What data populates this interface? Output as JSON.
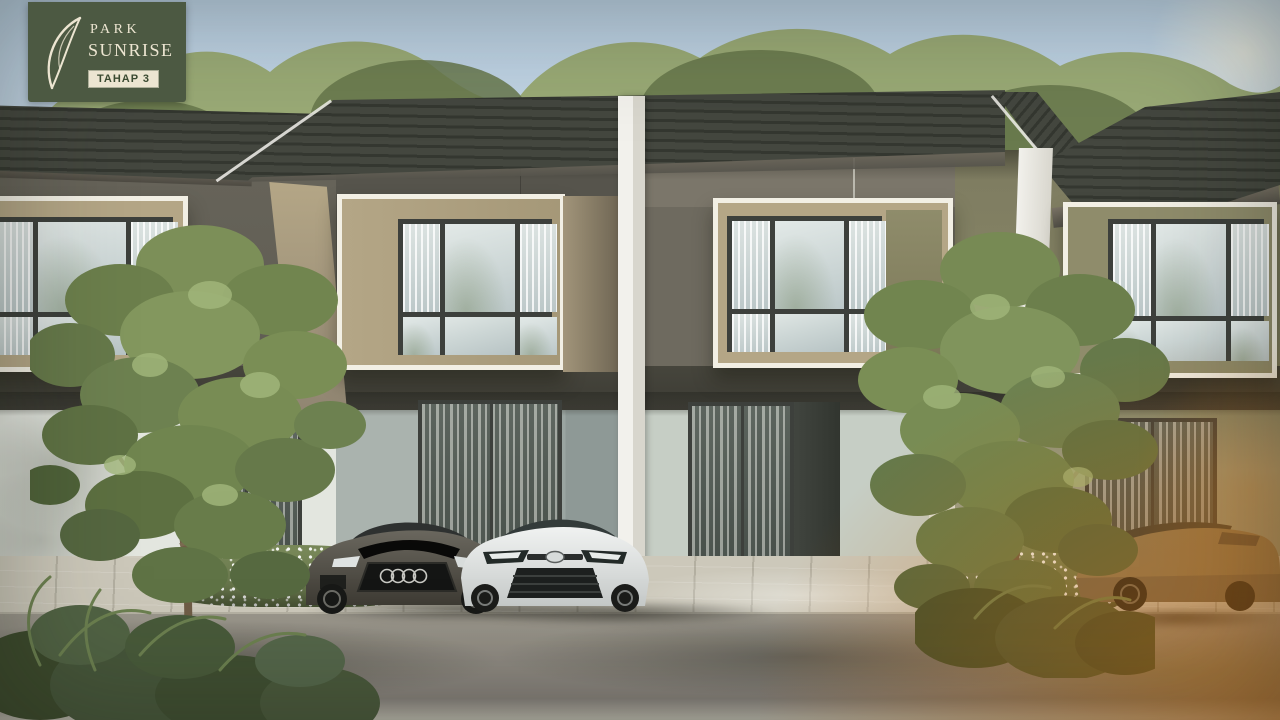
{
  "branding": {
    "line1": "PARK",
    "line2": "SUNRISE",
    "badge": "TAHAP 3",
    "logo_mark": "leaf-swoosh"
  },
  "scene": {
    "type": "architectural-exterior-render",
    "subject": "row of modern two-storey townhouses with parked cars and trees",
    "units_visible": 4,
    "cars": [
      "dark-grey-sedan",
      "white-sedan",
      "bronze-coupe"
    ]
  },
  "palette": {
    "sky_top": "#b9cfe2",
    "sky_bottom": "#dfe8ee",
    "canopy_back": "#9aaa76",
    "canopy_front": "#7a8b58",
    "canopy_dark": "#66774b",
    "roof": "#44473f",
    "roof_rib": "#343730",
    "soffit": "#7b7466",
    "wall_u1": "#5e5b51",
    "wall_u2": "#56544c",
    "wall_u3": "#6e6a5f",
    "wall_u4": "#8c8a69",
    "box_frame": "#f2efe4",
    "tan": "#b4a686",
    "olive_panel": "#8f8c6b",
    "win_frame": "#3d403c",
    "glass_hi": "#dfe6e4",
    "glass_lo": "#b7c3c4",
    "band": "#3c3b34",
    "g_white": "#e3e6df",
    "g_sage": "#c6cec5",
    "g_teal": "#8e9996",
    "g_olive": "#9aa18c",
    "pillar_hi": "#f2f1ec",
    "pillar_lo": "#d8d6cd",
    "pave": "#ccc8ba",
    "pave_edge": "#b5b1a3",
    "asphalt_hi": "#9a968b",
    "asphalt_lo": "#847f79",
    "flower_green": "#5d6b44",
    "trunk": "#6f5d46",
    "leaf_mid": "#7d9059",
    "leaf_dark": "#5f7245",
    "leaf_hi": "#a3b87c",
    "bush": "#3c4a2c",
    "car_dark": "#4b4840",
    "car_white": "#e2e4e2",
    "car_bronze": "#8b7b5a",
    "glow": "#c46a0c",
    "logo_bg": "#4c5942",
    "logo_cream": "#ece5d1",
    "logo_text_green": "#3a4a31"
  }
}
